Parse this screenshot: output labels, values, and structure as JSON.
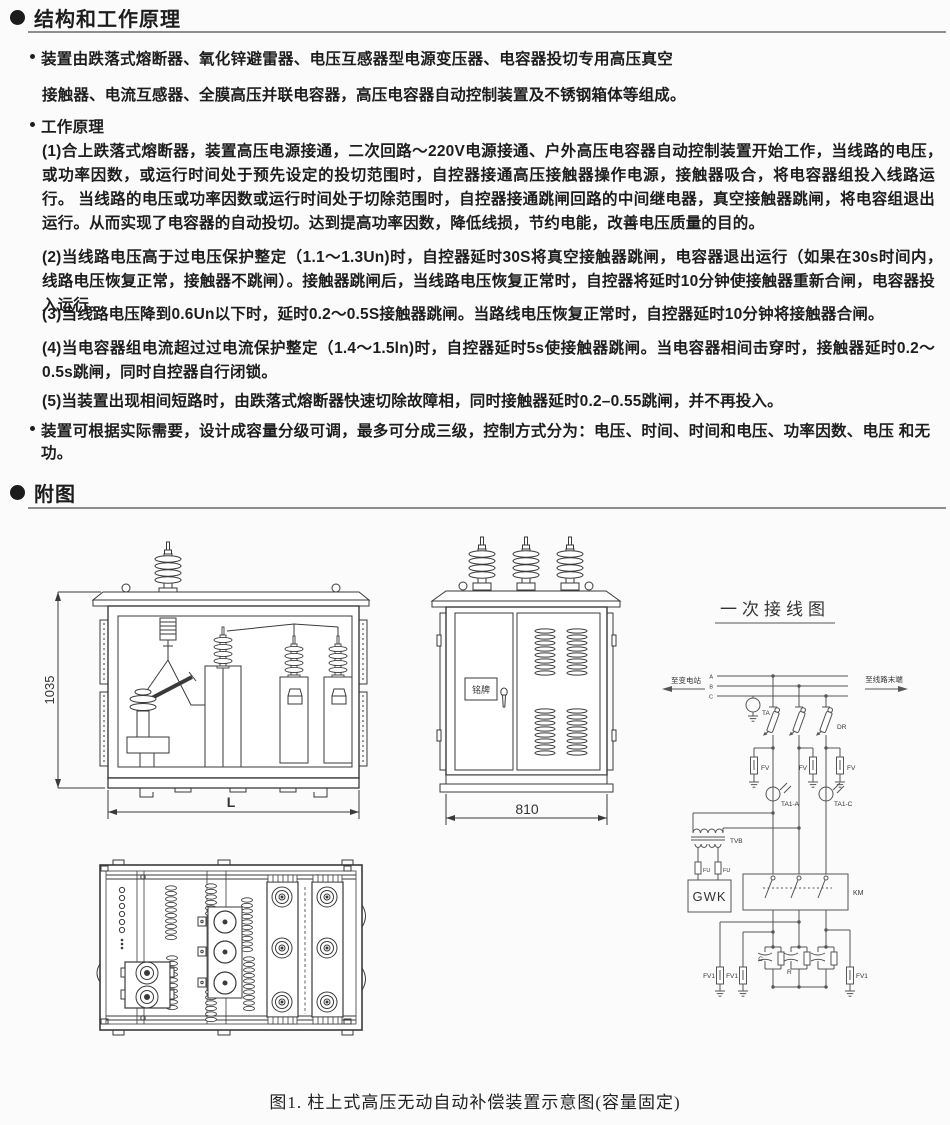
{
  "icons": {
    "section_marker": "filled-circle",
    "list_bullet": "small-dot"
  },
  "section_principle": {
    "title": "结构和工作原理",
    "intro_line1": "装置由跌落式熔断器、氧化锌避雷器、电压互感器型电源变压器、电容器投切专用高压真空",
    "intro_line2": "接触器、电流互感器、全膜高压并联电容器，高压电容器自动控制装置及不锈钢箱体等组成。",
    "working_principle_heading": "工作原理",
    "paras": [
      "(1)合上跌落式熔断器，装置高压电源接通，二次回路～220V电源接通、户外高压电容器自动控制装置开始工作，当线路的电压，　或功率因数，或运行时间处于预先设定的投切范围时，自控器接通高压接触器操作电源，接触器吸合，将电容器组投入线路运行。 当线路的电压或功率因数或运行时间处于切除范围时，自控器接通跳闸回路的中间继电器，真空接触器跳闸，将电容组退出运行。从而实现了电容器的自动投切。达到提高功率因数，降低线损，节约电能，改善电压质量的目的。",
      "(2)当线路电压高于过电压保护整定（1.1～1.3Un)时，自控器延时30S将真空接触器跳闸，电容器退出运行（如果在30s时间内，　线路电压恢复正常，接触器不跳闸）。接触器跳闸后，当线路电压恢复正常时，自控器将延时10分钟使接触器重新合闸，电容器投入运行。",
      "(3)当线路电压降到0.6Un以下时，延时0.2～0.5S接触器跳闸。当路线电压恢复正常时，自控器延时10分钟将接触器合闸。",
      "(4)当电容器组电流超过过电流保护整定（1.4～1.5ln)时，自控器延时5s使接触器跳闸。当电容器相间击穿时，接触器延时0.2～0.5s跳闸，同时自控器自行闭锁。",
      "(5)当装置出现相间短路时，由跌落式熔断器快速切除故障相，同时接触器延时0.2–0.55跳闸，并不再投入。"
    ],
    "capacity_note": "装置可根据实际需要，设计成容量分级可调，最多可分成三级，控制方式分为：电压、时间、时间和电压、功率因数、电压 和无功。"
  },
  "section_figures": {
    "title": "附图",
    "caption": "图1. 柱上式高压无动自动补偿装置示意图(容量固定)"
  },
  "front_view": {
    "height_dim": "1035",
    "width_dim": "L"
  },
  "side_view": {
    "width_dim": "810",
    "nameplate": "铭牌"
  },
  "schematic": {
    "title": "一次接线图",
    "to_substation": "至变电站",
    "to_line_end": "至线路末端",
    "phase_a": "A",
    "phase_b": "B",
    "phase_c": "C",
    "ta": "TA",
    "dr": "DR",
    "fv": "FV",
    "ta1_a": "TA1-A",
    "ta1_c": "TA1-C",
    "tvb": "TVB",
    "fu": "FU",
    "gwk": "GWK",
    "km": "KM",
    "cap": "C",
    "res": "R",
    "fv1": "FV1"
  }
}
